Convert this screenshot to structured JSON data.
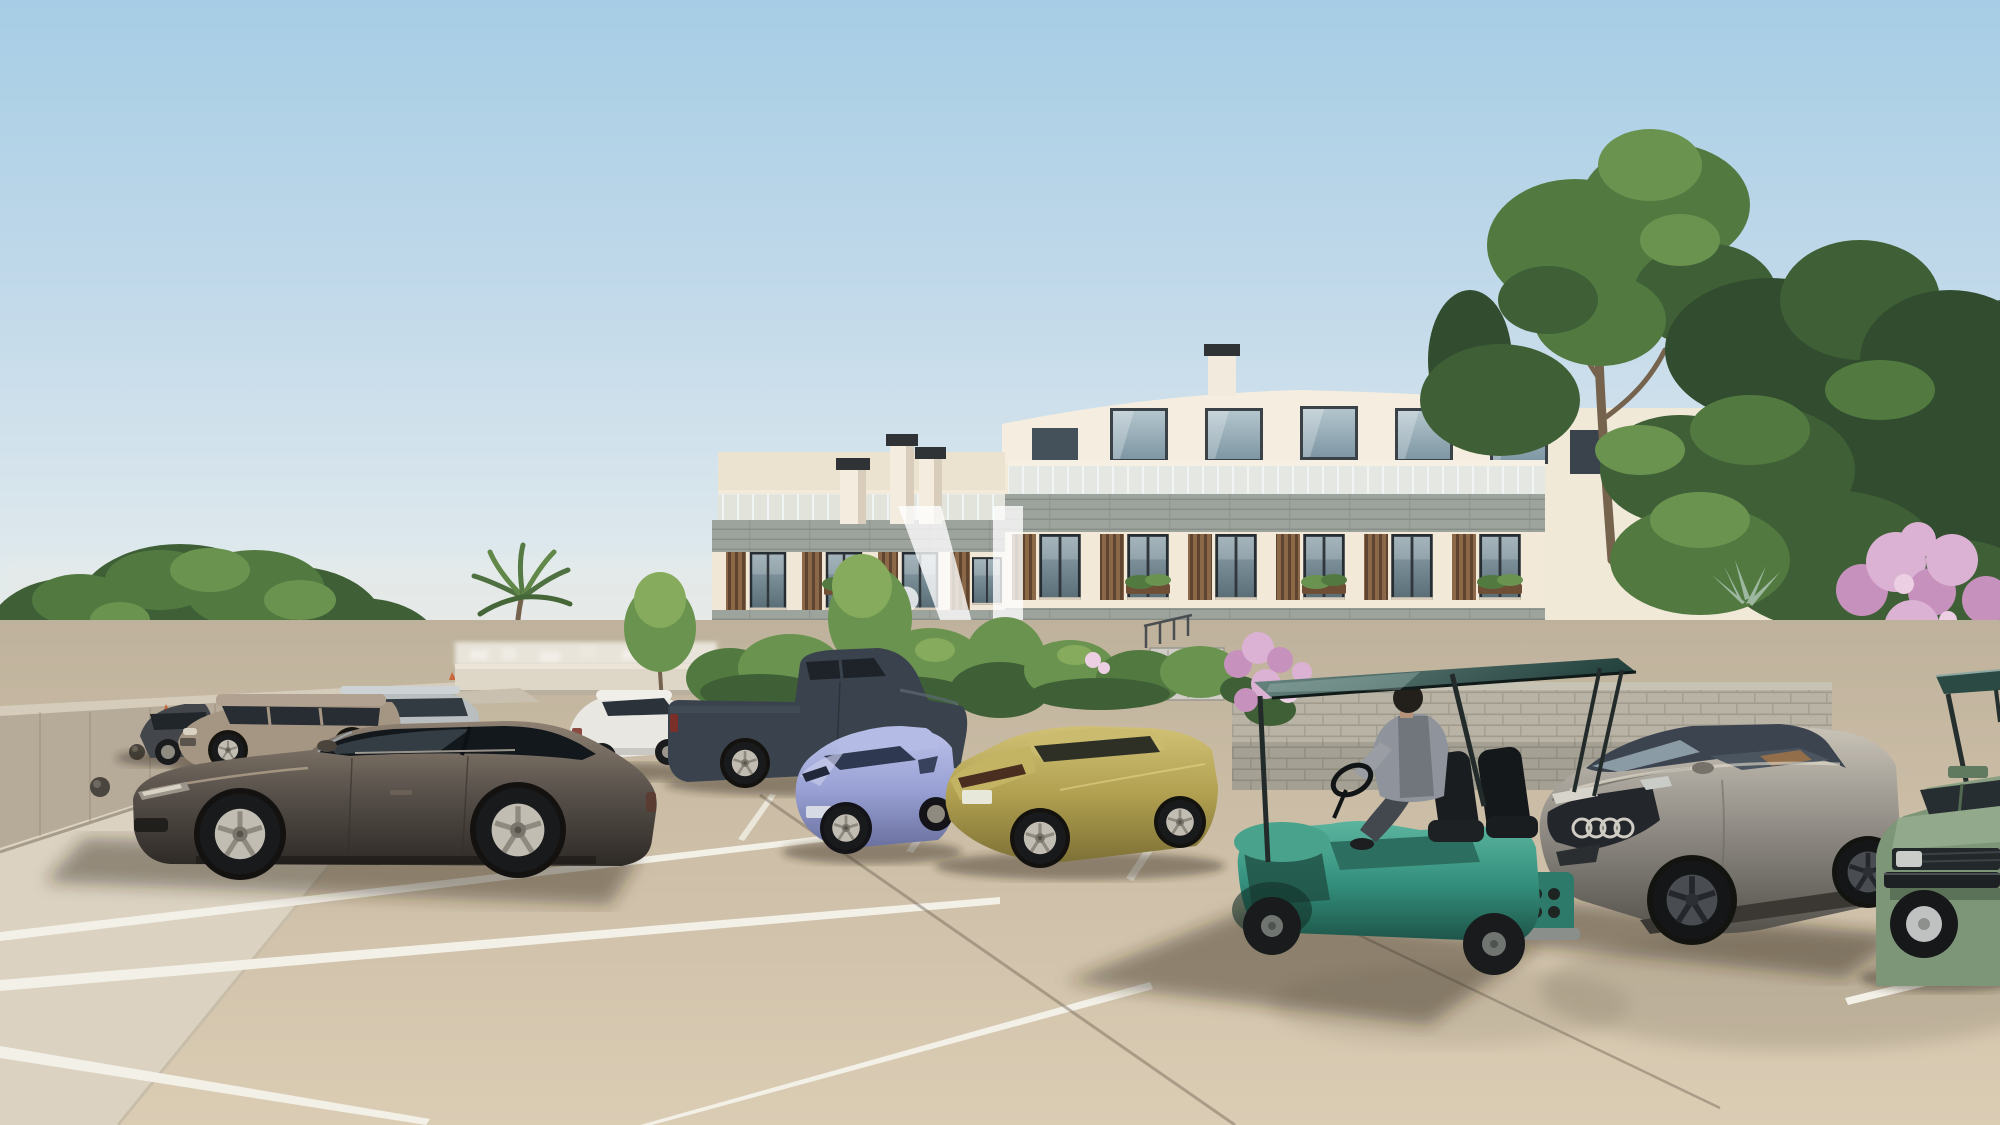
{
  "meta": {
    "scene": "Sunny parking lot in front of a modern Mediterranean apartment complex",
    "medium": "photorealistic architectural rendering",
    "sky": "clear blue, hazy at the horizon"
  },
  "watermark": {
    "label": "dot-M developer monogram",
    "color": "#ffffff",
    "opacity": 0.78
  },
  "palette": {
    "sky_top": "#a6cde5",
    "sky_mid": "#c3daea",
    "sky_horizon": "#eae9e3",
    "pavement_far": "#bfb29c",
    "pavement_near": "#dbcdb4",
    "stripe": "#f3f0e7",
    "building_wall": "#f2e9d8",
    "building_wall_left": "#f0e7d6",
    "penthouse_wall": "#f5eee0",
    "stone_band": "#9da39d",
    "wood_slats": "#8a6848",
    "glass_balustrade": "#d7e7ec",
    "stone_wall": "#b8b3a5",
    "concrete_wall": "#b6aa99",
    "flower_pink": "#c791bd"
  },
  "building": {
    "stories": 4,
    "style": "white render facade with grey stone bands, timber slat shutters and recessed penthouses",
    "chimneys": 5,
    "roof": "curved parapet with glass balustrade roof terraces"
  },
  "vehicles": [
    {
      "name": "dark bronze sedan",
      "color": "#57504a",
      "position": "foreground left, side view"
    },
    {
      "name": "beige SUV",
      "color": "#a59684",
      "position": "back row left"
    },
    {
      "name": "silver estate",
      "color": "#b9bec0",
      "position": "back row, behind SUV"
    },
    {
      "name": "dark grey compact",
      "color": "#43474c",
      "position": "far back row left"
    },
    {
      "name": "white sedan",
      "color": "#e9e7e2",
      "position": "middle row"
    },
    {
      "name": "slate-blue pickup truck",
      "color": "#3a434d",
      "position": "middle row"
    },
    {
      "name": "periwinkle hatchback",
      "color": "#9aa2d6",
      "position": "middle row"
    },
    {
      "name": "gold sedan",
      "color": "#b1a050",
      "position": "middle row right"
    },
    {
      "name": "teal golf cart with driver",
      "color": "#35917e",
      "canopy_color": "#22403c",
      "position": "foreground right, driving"
    },
    {
      "name": "grey gran turismo coupe",
      "color": "#8f8b84",
      "position": "right row, front three-quarter"
    },
    {
      "name": "sage green classic car",
      "color": "#7e9678",
      "position": "far right edge"
    },
    {
      "name": "second golf cart roof",
      "color": "#2c4a44",
      "position": "far right edge"
    }
  ],
  "environment": {
    "trees": "stone pine, ficus canopies and one palm",
    "flowers": "pink crape myrtle clusters",
    "walls": "concrete retaining wall with sphere bollards, dry stone garden wall",
    "markings": "white parking bay stripes on beige concrete"
  },
  "people": [
    {
      "name": "golf cart driver",
      "clothing": "grey top, dark trousers"
    }
  ]
}
